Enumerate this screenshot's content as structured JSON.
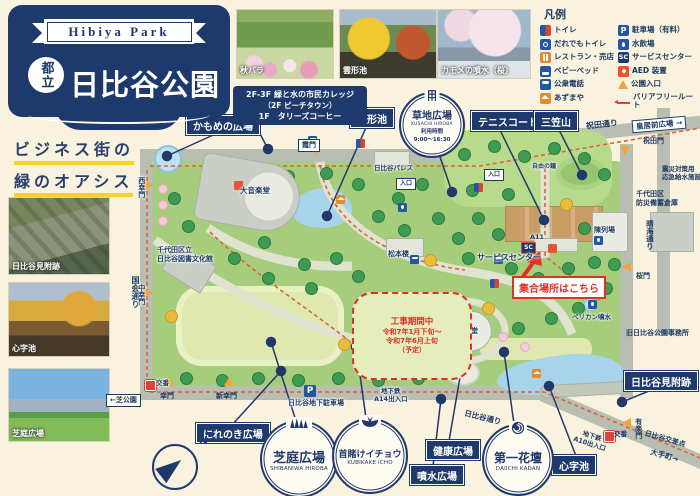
{
  "header": {
    "ribbon": "Hibiya Park",
    "prefix": "都立",
    "title": "日比谷公園"
  },
  "tagline": {
    "line1": "ビジネス街の",
    "line2": "緑のオアシス"
  },
  "top_photos": [
    {
      "caption": "秋バラ"
    },
    {
      "caption": "雲形池"
    },
    {
      "caption": "カモメの噴水（桜）"
    }
  ],
  "side_photos": [
    {
      "caption": "日比谷見附跡"
    },
    {
      "caption": "心字池"
    },
    {
      "caption": "芝庭広場"
    }
  ],
  "info_box": {
    "line1": "2F-3F 緑と水の市民カレッジ",
    "line2": "（2F ピーチタウン）",
    "line3": "1F　タリーズコーヒー"
  },
  "legend": {
    "title": "凡例",
    "left": [
      {
        "icon": "toilet-icon",
        "label": "トイレ"
      },
      {
        "icon": "accessible-toilet-icon",
        "label": "だれでもトイレ"
      },
      {
        "icon": "restaurant-icon",
        "label": "レストラン・売店"
      },
      {
        "icon": "baby-bed-icon",
        "label": "ベビーベッド"
      },
      {
        "icon": "public-phone-icon",
        "label": "公衆電話"
      },
      {
        "icon": "gazebo-icon",
        "label": "あずまや"
      }
    ],
    "right": [
      {
        "icon": "parking-icon",
        "label": "駐車場（有料）"
      },
      {
        "icon": "water-fountain-icon",
        "label": "水飲場"
      },
      {
        "icon": "service-center-icon",
        "label": "サービスセンター"
      },
      {
        "icon": "aed-icon",
        "label": "AED 装置"
      },
      {
        "icon": "park-entrance-icon",
        "label": "公園入口"
      },
      {
        "icon": "barrier-free-icon",
        "label": "バリアフリールート"
      }
    ]
  },
  "map": {
    "labels": {
      "kamome": "かもめの広場",
      "kumogata": "雲形池",
      "tennis": "テニスコート",
      "mikasa": "三笠山",
      "nirenoki": "にれのき広場",
      "kenko": "健康広場",
      "funsui": "噴水広場",
      "shinji": "心字池",
      "mitsuke": "日比谷見附跡"
    },
    "badges": {
      "kusachi": {
        "title": "草地広場",
        "roman": "KUSACHI HIROBA",
        "hours_label": "利用時間",
        "hours": "9:00～16:30"
      },
      "shibaniwa": {
        "title": "芝庭広場",
        "roman": "SHIBANIWA HIROBA"
      },
      "kubikake": {
        "title": "首賭けイチョウ",
        "roman": "KUBIKAKE ICHO"
      },
      "daiichi": {
        "title": "第一花壇",
        "roman": "DAIICHI KADAN"
      }
    },
    "meeting_note": "集合場所はこちら",
    "construction": {
      "l1": "工事期間中",
      "l2": "令和7年1月下旬～",
      "l3": "令和7年6月上旬",
      "l4": "（予定）"
    },
    "streets": {
      "kokkai": "国会通り",
      "iwaida": "祝田通り",
      "harumi": "晴海通り",
      "hibiya": "日比谷通り"
    },
    "gates": {
      "kasumi": "霞門",
      "nishisaiwai": "西幸門",
      "nakasaiwai": "中幸門",
      "saiwai": "幸門",
      "shinsaiwai": "新幸門",
      "iwaidamon": "祝田門",
      "sakuramon": "桜門",
      "yurakumon": "有楽門"
    },
    "directions": {
      "kokyo": "皇居前広場 →",
      "shiba": "←芝公園",
      "otemachi": "大手町→",
      "kosaten": "日比谷交差点"
    },
    "pois": {
      "daiongakudo": "大音楽堂",
      "library1": "千代田区立",
      "library2": "日比谷図書文化館",
      "matsumotoro": "松本楼",
      "koongakudo": "小音楽堂",
      "palace": "日比谷パレス",
      "chinretsujo": "陳列場",
      "pelican": "ペリカン噴水",
      "kyujimusho": "旧日比谷公園事務所",
      "bichiku1": "千代田区",
      "bichiku2": "防災備蓄倉庫",
      "kyusui1": "震災対策用",
      "kyusui2": "応急給水施設",
      "parking": "日比谷地下駐車場",
      "chikatetsu": "地下鉄",
      "a14": "A14出入口",
      "a10": "A10出入口",
      "a11": "A11",
      "iriguchi": "入口",
      "service": "サービスセンター",
      "koban": "交番",
      "jiyunokane": "自由の鐘"
    },
    "compass_n": "N",
    "icons": {
      "p": "P",
      "sc": "SC"
    }
  }
}
